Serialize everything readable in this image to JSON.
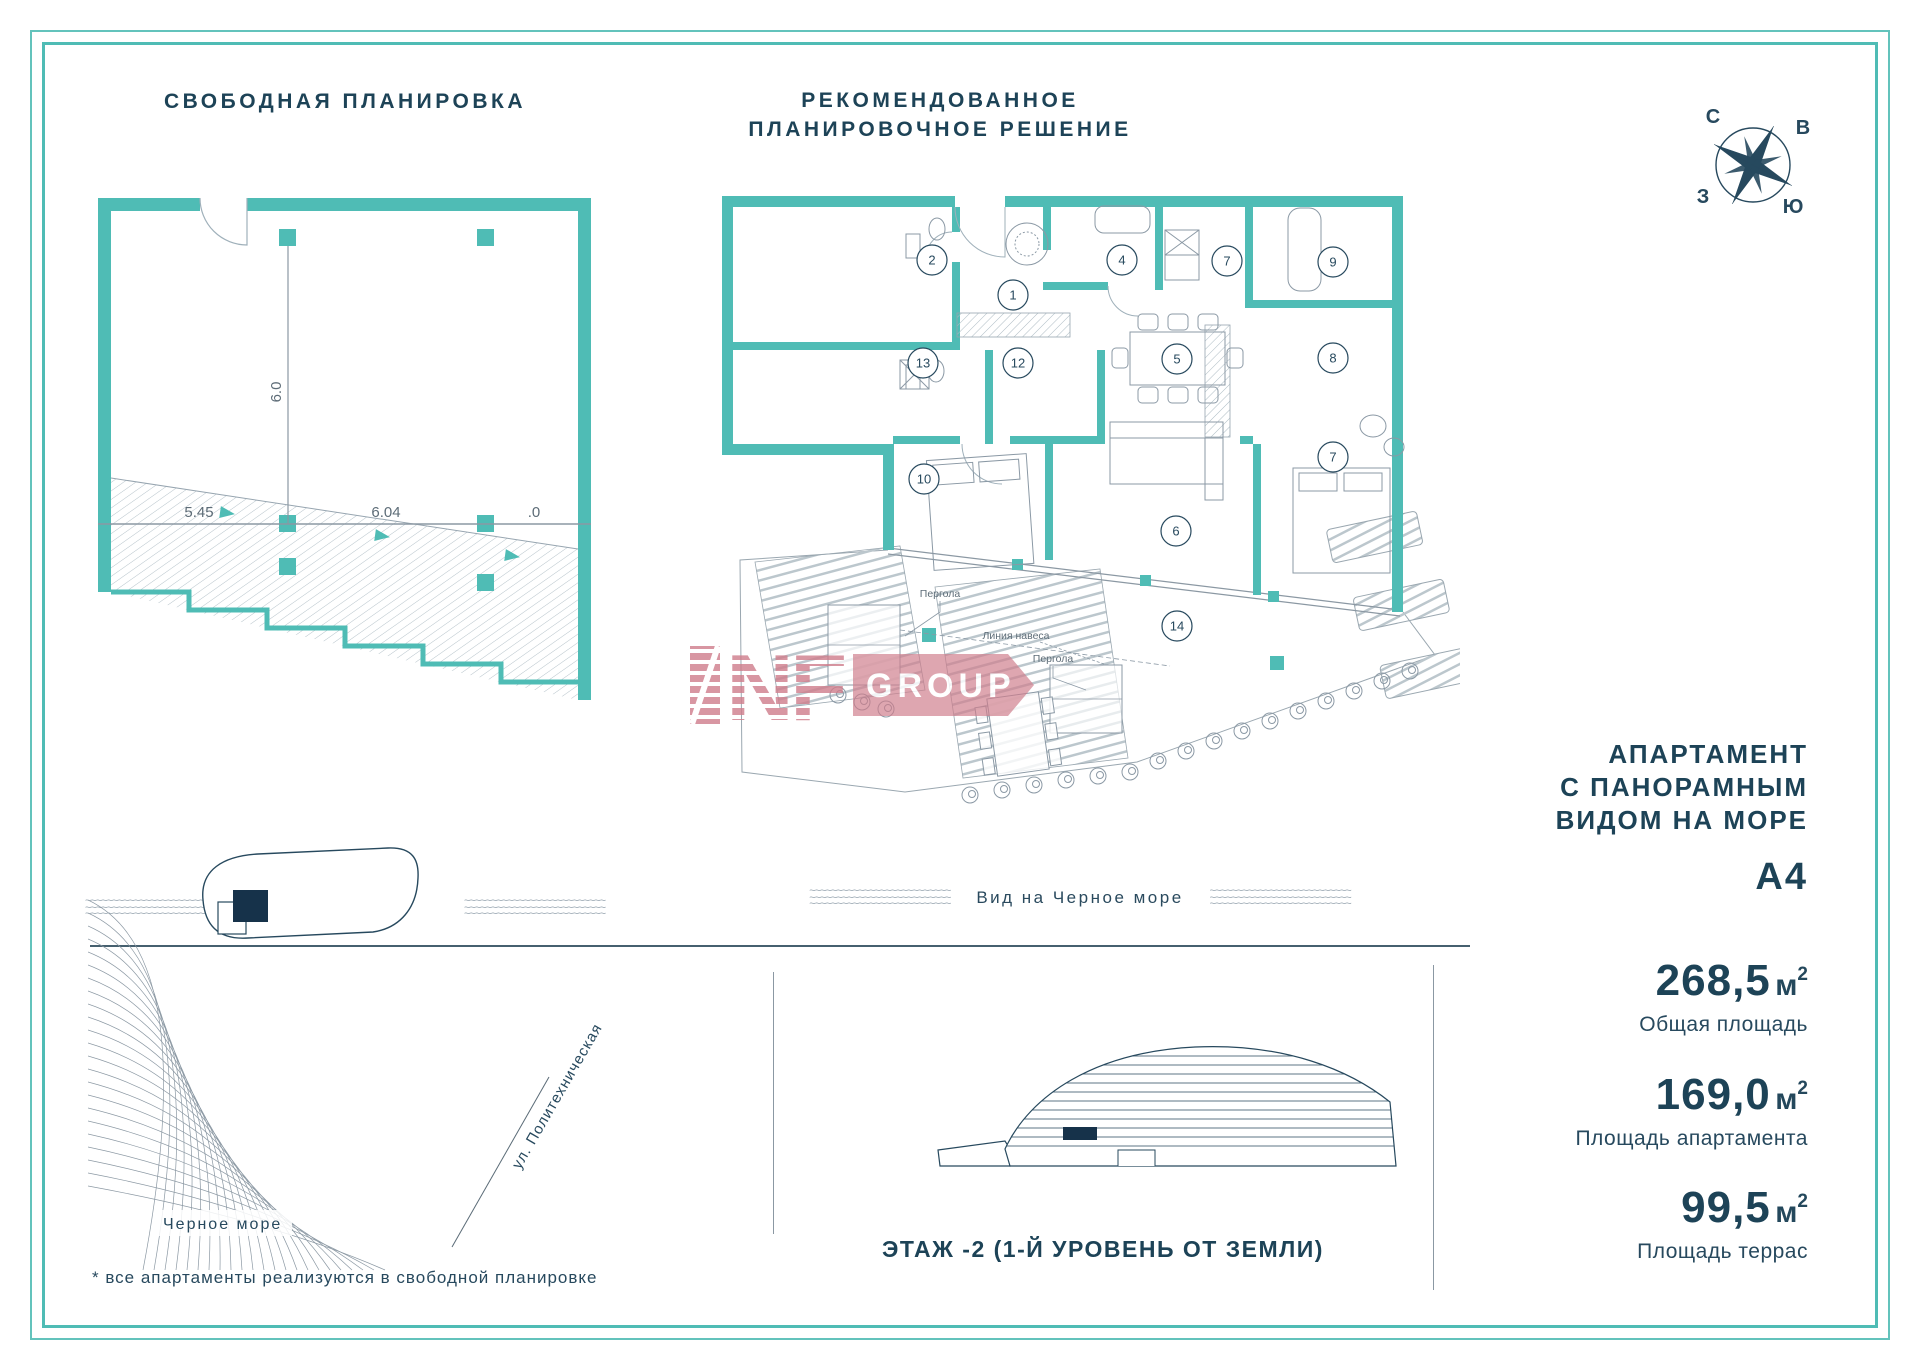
{
  "header": {
    "left_title": "СВОБОДНАЯ ПЛАНИРОВКА",
    "right_title_line1": "РЕКОМЕНДОВАННОЕ",
    "right_title_line2": "ПЛАНИРОВОЧНОЕ РЕШЕНИЕ"
  },
  "compass": {
    "n": "С",
    "e": "В",
    "w": "З",
    "s": "Ю"
  },
  "free_plan": {
    "dim_h1": "5.45",
    "dim_h2": "6.04",
    "dim_h3": ".0",
    "dim_v": "6.0",
    "caption": "Вид на Черное море"
  },
  "detail_plan": {
    "caption": "Вид на Черное море",
    "pergola_label": "Пергола",
    "pergola_label_2": "Пергола",
    "canopy_label": "Линия навеса",
    "rooms": [
      {
        "n": "1",
        "x": 313,
        "y": 145
      },
      {
        "n": "2",
        "x": 232,
        "y": 110
      },
      {
        "n": "4",
        "x": 422,
        "y": 110
      },
      {
        "n": "7",
        "x": 527,
        "y": 111
      },
      {
        "n": "9",
        "x": 633,
        "y": 112
      },
      {
        "n": "5",
        "x": 477,
        "y": 209
      },
      {
        "n": "8",
        "x": 633,
        "y": 208
      },
      {
        "n": "12",
        "x": 318,
        "y": 213
      },
      {
        "n": "13",
        "x": 223,
        "y": 213
      },
      {
        "n": "10",
        "x": 224,
        "y": 329
      },
      {
        "n": "6",
        "x": 476,
        "y": 381
      },
      {
        "n": "7",
        "x": 633,
        "y": 307
      },
      {
        "n": "14",
        "x": 477,
        "y": 476
      }
    ]
  },
  "unit_info": {
    "title_l1": "АПАРТАМЕНТ",
    "title_l2": "С ПАНОРАМНЫМ",
    "title_l3": "ВИДОМ НА МОРЕ",
    "unit_code": "А4"
  },
  "stats": [
    {
      "value": "268,5",
      "unit": "м",
      "sup": "2",
      "label": "Общая площадь"
    },
    {
      "value": "169,0",
      "unit": "м",
      "sup": "2",
      "label": "Площадь апартамента"
    },
    {
      "value": "99,5",
      "unit": "м",
      "sup": "2",
      "label": "Площадь террас"
    }
  ],
  "site": {
    "sea": "Черное море",
    "street": "ул. Политехническая",
    "footnote": "* все апартаменты реализуются в свободной планировке"
  },
  "section": {
    "floor": "ЭТАЖ -2 (1-Й УРОВЕНЬ ОТ ЗЕМЛИ)"
  },
  "watermark": {
    "letters": "NF",
    "banner": "GROUP"
  },
  "colors": {
    "teal": "#4fbcb5",
    "navy": "#27495e",
    "grey": "#8b98a3",
    "pink": "#cf7d8b"
  }
}
